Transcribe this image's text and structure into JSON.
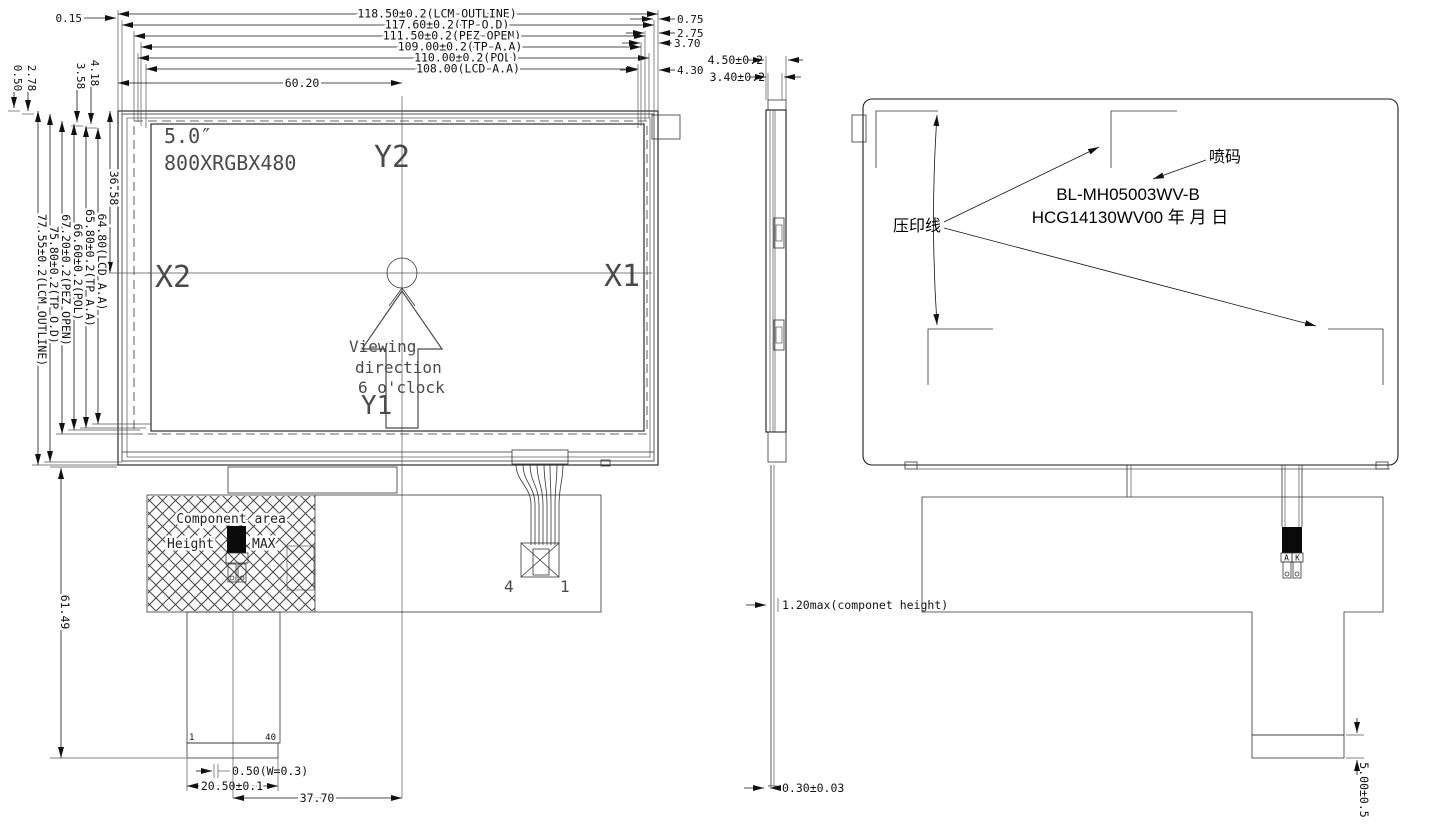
{
  "title": "LCM outline drawing",
  "ink": "#1a1a1a",
  "front": {
    "top_dims": [
      "118.50±0.2(LCM OUTLINE)",
      "117.60±0.2(TP O.D)",
      "111.50±0.2(PEZ OPEN)",
      "109.00±0.2(TP A.A)",
      "110.00±0.2(POL)",
      "108.00(LCD A.A)"
    ],
    "offset_top_left": "0.15",
    "right_offsets": [
      "0.75",
      "2.75",
      "3.70",
      "4.30"
    ],
    "width_to_center": "60.20",
    "left_small_offsets": [
      "0.50",
      "2.78",
      "3.58",
      "4.18"
    ],
    "left_dims": [
      "77.55±0.2(LCM OUTLINE)",
      "75.80±0.2(TP O.D)",
      "67.20±0.2(PEZ OPEN)",
      "66.60±0.2(POL)",
      "65.80±0.2(TP A.A)",
      "64.80(LCD A.A)"
    ],
    "height_to_center": "36.58",
    "size_label": "5.0″",
    "resolution": "800XRGBX480",
    "axis": {
      "y2": "Y2",
      "y1": "Y1",
      "x1": "X1",
      "x2": "X2"
    },
    "viewing": [
      "Viewing",
      "direction",
      "6 o'clock"
    ],
    "component_area": {
      "line1": "Component area",
      "line2_left": "Height",
      "line2_right": "MAX"
    },
    "pin_first": "1",
    "pin_last": "40",
    "pin_pitch": "0.50(W=0.3)",
    "connector_width": "20.50±0.1",
    "center_offset": "37.70",
    "tail_height": "61.49",
    "tp_pin_left": "4",
    "tp_pin_right": "1"
  },
  "side": {
    "thickness_total": "4.50±0.2",
    "thickness_tp": "3.40±0.2",
    "component_height": "1.20max(componet height)",
    "film_thickness": "0.30±0.03"
  },
  "rear": {
    "stamp_line_label": "压印线",
    "inkjet_label": "喷码",
    "part_number": "BL-MH05003WV-B",
    "code_line": "HCG14130WV00  年 月 日",
    "led_anode": "A",
    "led_cathode": "K",
    "tail_band_height": "5.00±0.5"
  }
}
